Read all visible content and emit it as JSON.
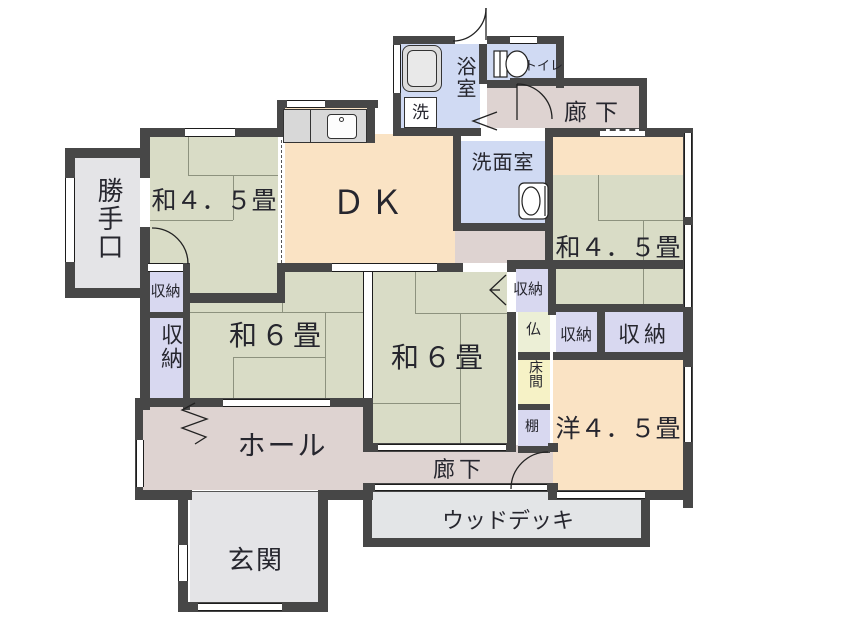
{
  "floorplan": {
    "title": "house-floor-plan",
    "rooms": {
      "katteguchi": {
        "label": "勝手口"
      },
      "wa45_top_left": {
        "label": "和４．５畳"
      },
      "dk": {
        "label": "ＤＫ"
      },
      "bathroom": {
        "label": "浴室"
      },
      "laundry": {
        "label": "洗"
      },
      "toilet": {
        "label": "トイレ"
      },
      "hallway_top": {
        "label": "廊下"
      },
      "washroom": {
        "label": "洗面室"
      },
      "wa45_top_right": {
        "label": "和４．５畳"
      },
      "closet_small_left": {
        "label": "収納"
      },
      "closet_left": {
        "label": "収納"
      },
      "wa6_left": {
        "label": "和６畳"
      },
      "wa6_center": {
        "label": "和６畳"
      },
      "closet_small_right": {
        "label": "収納"
      },
      "butsuma": {
        "label": "仏"
      },
      "closet_mid": {
        "label": "収納"
      },
      "closet_right": {
        "label": "収納"
      },
      "tokonoma": {
        "label": "床間"
      },
      "tana": {
        "label": "棚"
      },
      "yo45": {
        "label": "洋４．５畳"
      },
      "hall": {
        "label": "ホール"
      },
      "hallway_bottom": {
        "label": "廊下"
      },
      "genkan": {
        "label": "玄関"
      },
      "wood_deck": {
        "label": "ウッドデッキ"
      }
    },
    "colors": {
      "wall": "#474747",
      "tatami": "#d9dcc6",
      "wood_floor": "#fae3c4",
      "wet_area": "#d0daf3",
      "closet": "#d8d8f0",
      "corridor": "#ded3d1",
      "entry": "#e4e4e7",
      "deck": "#e3e5e7",
      "tokonoma": "#f6f2c6",
      "butsuma": "#ecefd6"
    }
  }
}
